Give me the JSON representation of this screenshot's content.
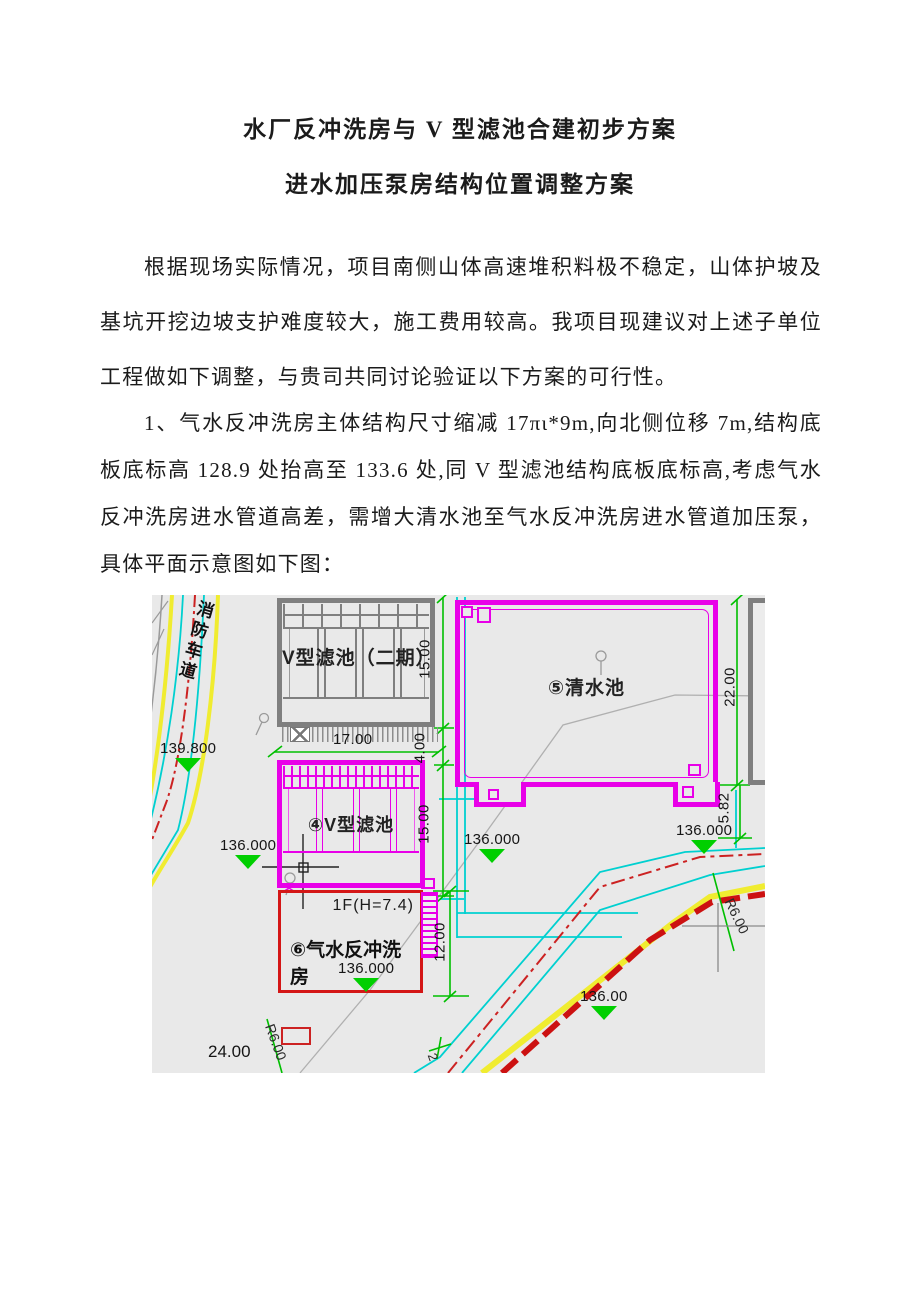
{
  "document": {
    "title_line1": "水厂反冲洗房与 V 型滤池合建初步方案",
    "title_line2": "进水加压泵房结构位置调整方案",
    "paragraph1": "根据现场实际情况，项目南侧山体高速堆积料极不稳定，山体护坡及基坑开挖边坡支护难度较大，施工费用较高。我项目现建议对上述子单位工程做如下调整，与贵司共同讨论验证以下方案的可行性。",
    "paragraph2": "1、气水反冲洗房主体结构尺寸缩减 17πι*9m,向北侧位移 7m,结构底板底标高 128.9 处抬高至 133.6 处,同 V 型滤池结构底板底标高,考虑气水反冲洗房进水管道高差，需增大清水池至气水反冲洗房进水管道加压泵，具体平面示意图如下图："
  },
  "drawing": {
    "labels": {
      "road": "消防车道",
      "filter_phase2": "V型滤池（二期）",
      "clear_water_pool": "⑤清水池",
      "v_filter": "④V型滤池",
      "backwash_house": "⑥气水反冲洗房",
      "floor": "1F(H=7.4)"
    },
    "dimensions": {
      "d17": "17.00",
      "d15a": "15.00",
      "d4": "4.00",
      "d15b": "15.00",
      "d22": "22.00",
      "d582": "5.82",
      "d12": "12.00",
      "d24": "24.00",
      "r6_right": "R6.00",
      "r6_left": "R6.00",
      "n2": "2"
    },
    "elevations": {
      "e139": "139.800",
      "e136_left": "136.000",
      "e136_mid": "136.000",
      "e136_right": "136.000",
      "e136_wash": "136.000",
      "e136_bottom": "136.00"
    },
    "colors": {
      "magenta": "#e800e8",
      "red": "#d41616",
      "road_red": "#cc2222",
      "green": "#00bf00",
      "marker_green": "#00cf00",
      "cyan": "#00d0d0",
      "yellow": "#f0ec30",
      "gray": "#7f7f7f",
      "background": "#e9e9e9"
    }
  }
}
